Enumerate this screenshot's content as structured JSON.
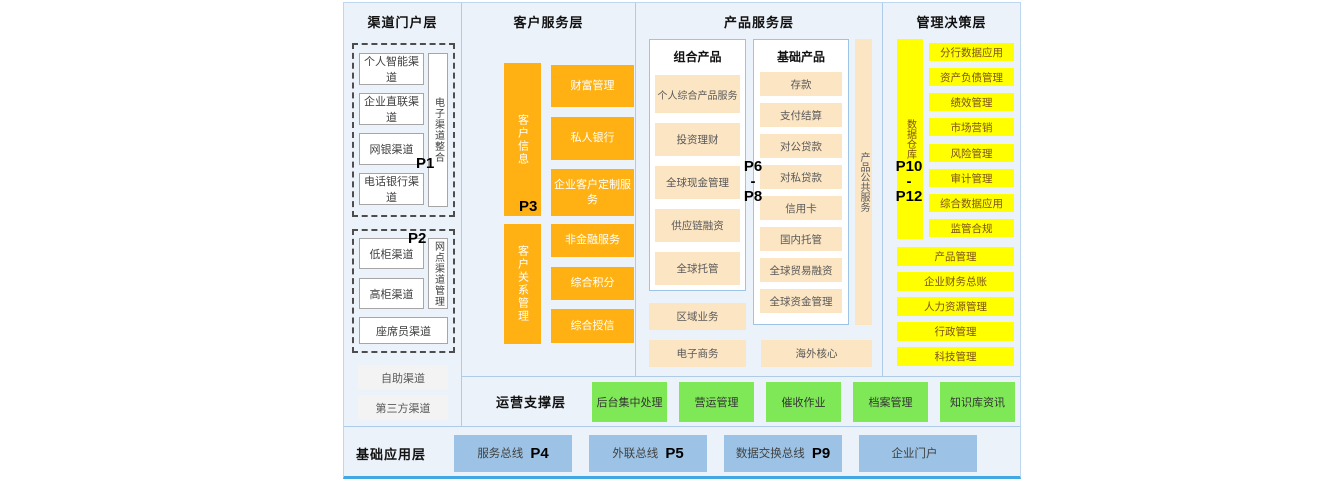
{
  "channel": {
    "title": "渠道门户层",
    "p1_label": "P1",
    "p2_label": "P2",
    "group1": {
      "boxes": [
        "个人智能渠道",
        "企业直联渠道",
        "网银渠道",
        "电话银行渠道"
      ],
      "side_bar": "电子渠道整合"
    },
    "group2": {
      "boxes": [
        "低柜渠道",
        "高柜渠道"
      ],
      "side_bar": "网点渠道管理",
      "bottom_box": "座席员渠道"
    },
    "extra_boxes": [
      "自助渠道",
      "第三方渠道"
    ]
  },
  "customer": {
    "title": "客户服务层",
    "p3_label": "P3",
    "upper_bar": "客户信息",
    "upper_boxes": [
      "财富管理",
      "私人银行",
      "企业客户定制服务"
    ],
    "lower_bar": "客户关系管理",
    "lower_boxes": [
      "非金融服务",
      "综合积分",
      "综合授信"
    ]
  },
  "product": {
    "title": "产品服务层",
    "p_label": {
      "top": "P6",
      "mid": "-",
      "bottom": "P8"
    },
    "combo": {
      "title": "组合产品",
      "boxes": [
        "个人综合产品服务",
        "投资理财",
        "全球现金管理",
        "供应链融资",
        "全球托管"
      ]
    },
    "basic": {
      "title": "基础产品",
      "boxes": [
        "存款",
        "支付结算",
        "对公贷款",
        "对私贷款",
        "信用卡",
        "国内托管",
        "全球贸易融资",
        "全球资金管理"
      ]
    },
    "side_bar": "产品公共服务",
    "regional_box": "区域业务",
    "ecommerce_box": "电子商务",
    "overseas_box": "海外核心"
  },
  "management": {
    "title": "管理决策层",
    "p_label": {
      "top": "P10",
      "mid": "-",
      "bottom": "P12"
    },
    "side_bar": "数据仓库",
    "narrow_boxes": [
      "分行数据应用",
      "资产负债管理",
      "绩效管理",
      "市场营销",
      "风险管理",
      "审计管理",
      "综合数据应用",
      "监管合规"
    ],
    "wide_boxes": [
      "产品管理",
      "企业财务总账",
      "人力资源管理",
      "行政管理",
      "科技管理"
    ]
  },
  "ops": {
    "title": "运营支撑层",
    "boxes": [
      "后台集中处理",
      "营运管理",
      "催收作业",
      "档案管理",
      "知识库资讯"
    ]
  },
  "base": {
    "title": "基础应用层",
    "boxes": [
      {
        "label": "服务总线",
        "p": "P4"
      },
      {
        "label": "外联总线",
        "p": "P5"
      },
      {
        "label": "数据交换总线",
        "p": "P9"
      },
      {
        "label": "企业门户",
        "p": ""
      }
    ]
  },
  "colors": {
    "background": "#ECF2FA",
    "orange": "#FFB114",
    "cream": "#FBE5C3",
    "yellow": "#FFFF00",
    "green": "#7FE857",
    "blue_box": "#9CC3E5",
    "divider": "#AECBE8",
    "bottom_strip": "#41A8E3"
  }
}
